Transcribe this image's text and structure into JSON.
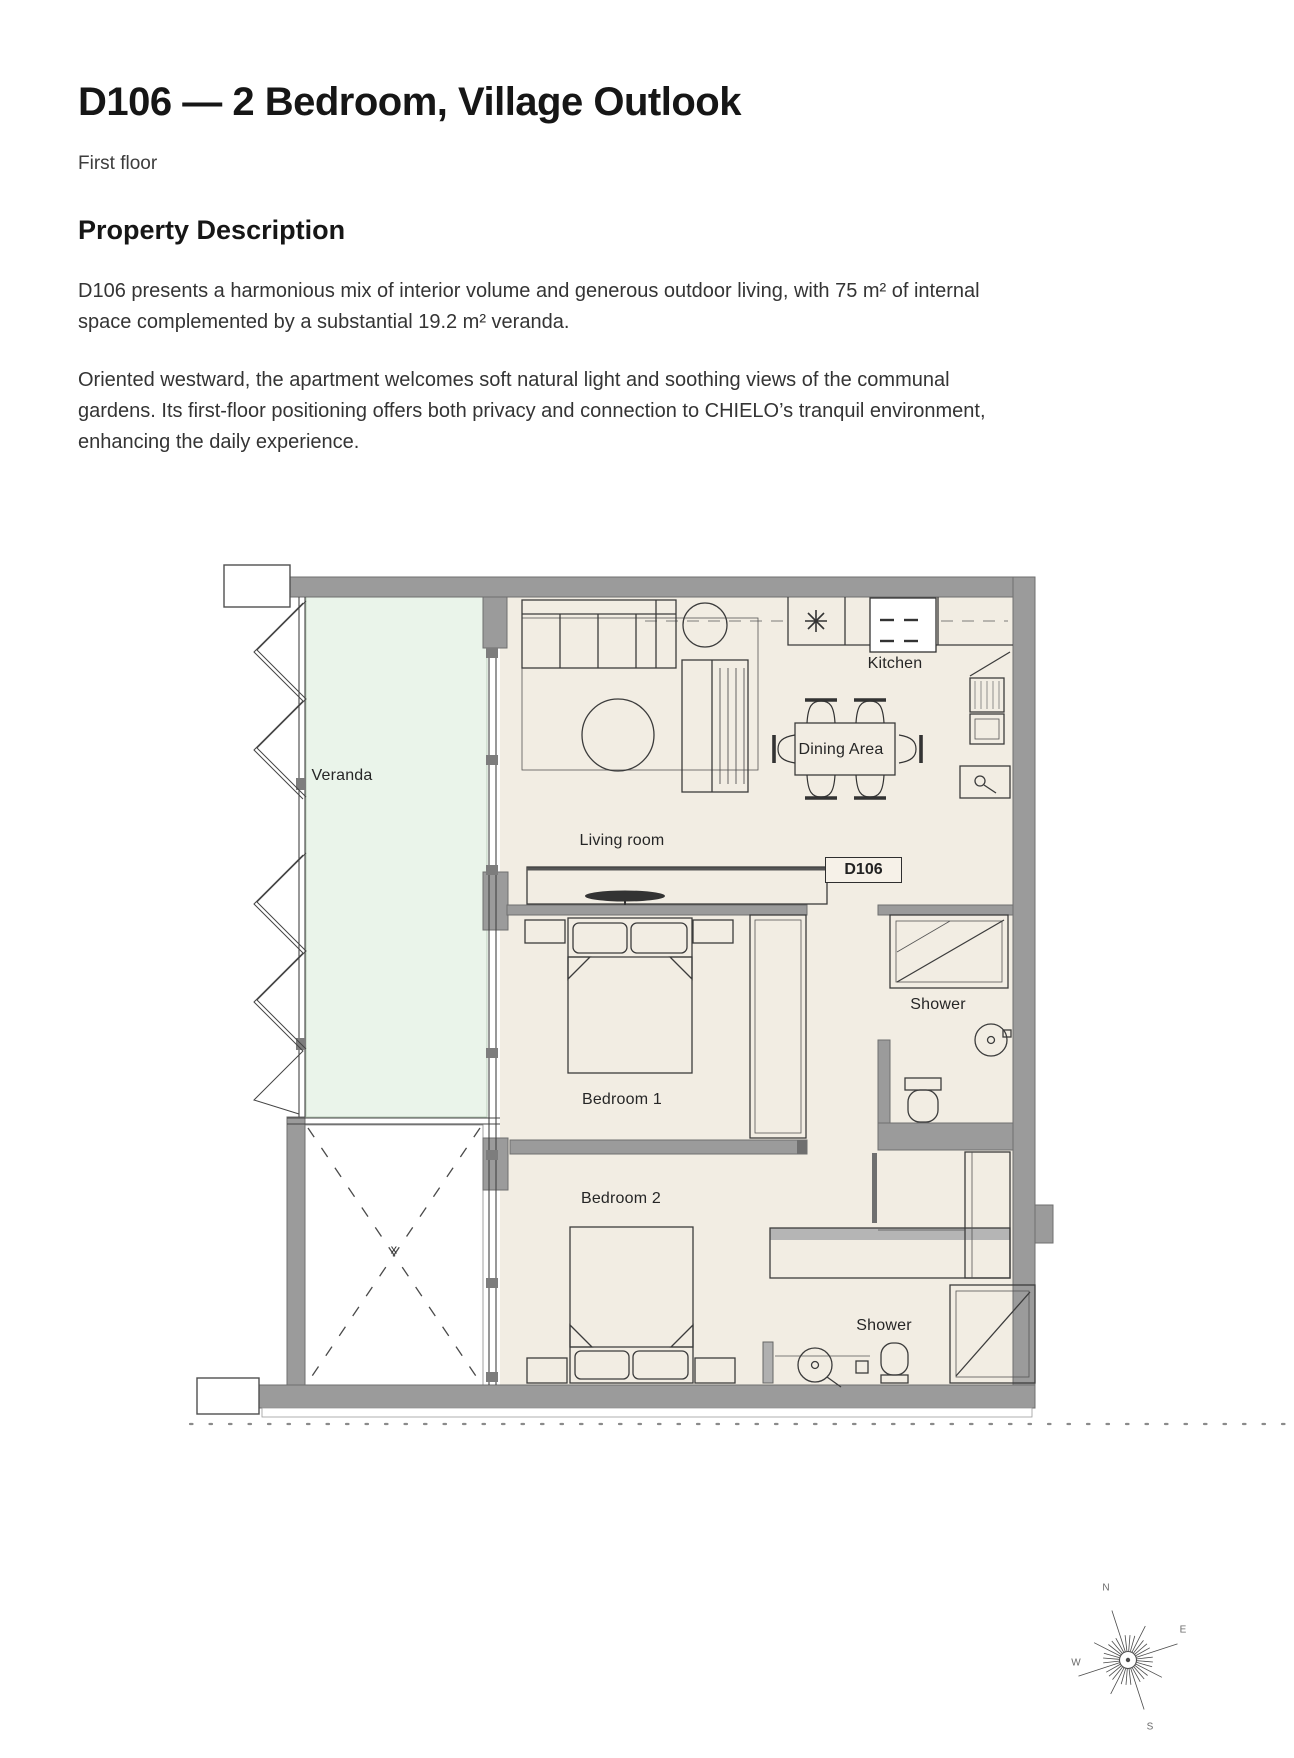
{
  "page": {
    "title": "D106 — 2 Bedroom, Village Outlook",
    "subtitle": "First floor",
    "section_heading": "Property Description",
    "paragraph_1": "D106 presents a harmonious mix of interior volume and generous outdoor living, with 75 m² of internal space complemented by a substantial 19.2 m² veranda.",
    "paragraph_2": "Oriented westward, the apartment welcomes soft natural light and soothing views of the communal gardens. Its first-floor positioning offers both privacy and connection to CHIELO’s tranquil environment, enhancing the daily experience."
  },
  "floorplan": {
    "unit_label": "D106",
    "rooms": {
      "veranda": "Veranda",
      "living_room": "Living room",
      "kitchen": "Kitchen",
      "dining_area": "Dining Area",
      "bedroom_1": "Bedroom 1",
      "bedroom_2": "Bedroom 2",
      "shower_1": "Shower",
      "shower_2": "Shower",
      "void_marker": "x"
    },
    "colors": {
      "wall": "#9b9b9b",
      "floor": "#f2ede3",
      "veranda_floor": "#eaf4ea",
      "line": "#3c3c3c"
    }
  },
  "compass": {
    "n": "N",
    "e": "E",
    "s": "S",
    "w": "W"
  }
}
